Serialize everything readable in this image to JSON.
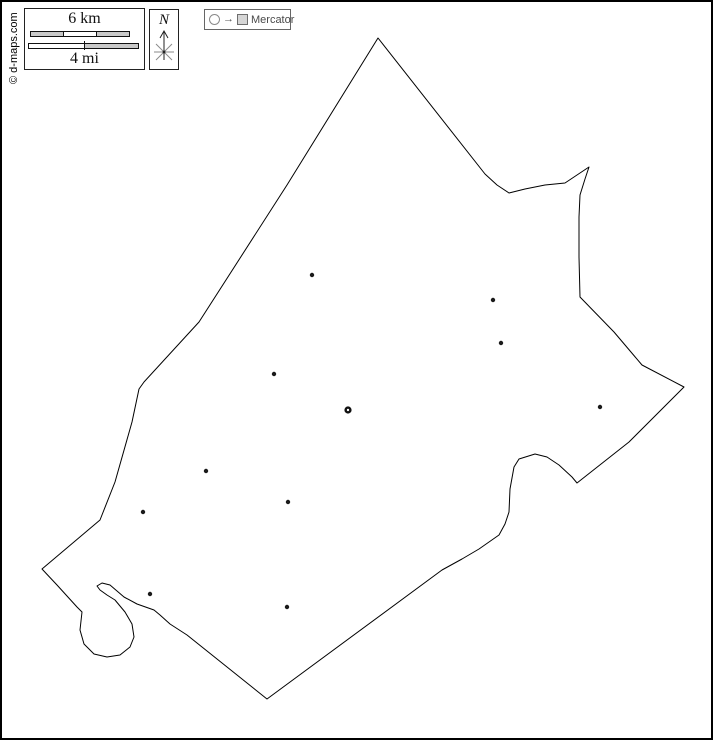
{
  "credit": {
    "text": "© d-maps.com"
  },
  "scale_bar": {
    "km_label": "6 km",
    "mi_label": "4 mi",
    "bar_fill": "#c9c9c9",
    "bar_empty": "#ffffff",
    "bar_border": "#111111"
  },
  "compass": {
    "north_label": "N"
  },
  "projection": {
    "label": "Mercator",
    "arrow": "→"
  },
  "map": {
    "stroke": "#000000",
    "town_color": "#1a1a1a",
    "capital_ring_color": "#111111",
    "boundary": [
      [
        376,
        36
      ],
      [
        483,
        172
      ],
      [
        495,
        183
      ],
      [
        507,
        191
      ],
      [
        523,
        187
      ],
      [
        543,
        183
      ],
      [
        563,
        181
      ],
      [
        587,
        165
      ],
      [
        583,
        177
      ],
      [
        578,
        193
      ],
      [
        577,
        215
      ],
      [
        577,
        255
      ],
      [
        578,
        295
      ],
      [
        612,
        330
      ],
      [
        640,
        363
      ],
      [
        682,
        385
      ],
      [
        627,
        440
      ],
      [
        575,
        481
      ],
      [
        570,
        475
      ],
      [
        557,
        463
      ],
      [
        545,
        455
      ],
      [
        533,
        452
      ],
      [
        517,
        457
      ],
      [
        512,
        465
      ],
      [
        508,
        487
      ],
      [
        507,
        510
      ],
      [
        503,
        522
      ],
      [
        497,
        533
      ],
      [
        487,
        540
      ],
      [
        477,
        547
      ],
      [
        460,
        557
      ],
      [
        440,
        568
      ],
      [
        265,
        697
      ],
      [
        185,
        633
      ],
      [
        168,
        622
      ],
      [
        158,
        613
      ],
      [
        152,
        608
      ],
      [
        135,
        602
      ],
      [
        122,
        595
      ],
      [
        108,
        583
      ],
      [
        100,
        581
      ],
      [
        95,
        584
      ],
      [
        98,
        588
      ],
      [
        105,
        593
      ],
      [
        113,
        598
      ],
      [
        123,
        610
      ],
      [
        130,
        622
      ],
      [
        132,
        635
      ],
      [
        128,
        645
      ],
      [
        118,
        653
      ],
      [
        105,
        655
      ],
      [
        92,
        652
      ],
      [
        82,
        642
      ],
      [
        78,
        628
      ],
      [
        80,
        610
      ],
      [
        75,
        605
      ],
      [
        55,
        583
      ],
      [
        40,
        567
      ],
      [
        98,
        518
      ],
      [
        113,
        480
      ],
      [
        130,
        420
      ],
      [
        137,
        387
      ],
      [
        142,
        380
      ],
      [
        197,
        320
      ],
      [
        285,
        183
      ]
    ],
    "towns": [
      [
        310,
        273
      ],
      [
        491,
        298
      ],
      [
        499,
        341
      ],
      [
        272,
        372
      ],
      [
        598,
        405
      ],
      [
        204,
        469
      ],
      [
        286,
        500
      ],
      [
        141,
        510
      ],
      [
        148,
        592
      ],
      [
        285,
        605
      ]
    ],
    "capital": [
      346,
      408
    ]
  }
}
